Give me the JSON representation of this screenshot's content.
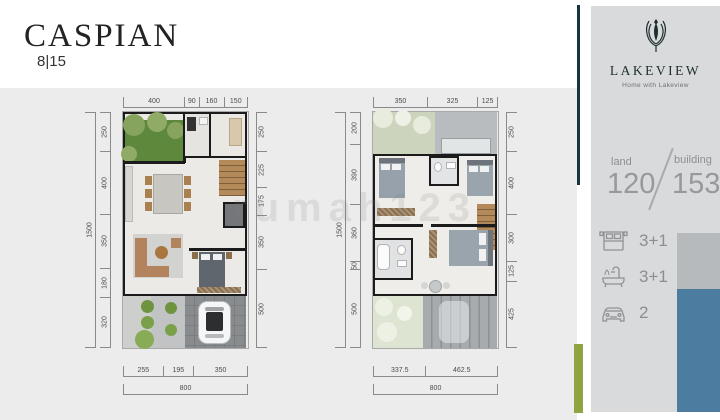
{
  "title": {
    "name": "CASPIAN",
    "lot": "8|15"
  },
  "watermark": "rumah123",
  "sidebar": {
    "brand": "LAKEVIEW",
    "tagline": "Home with Lakeview",
    "land_label": "land",
    "land_value": "120",
    "building_label": "building",
    "building_value": "153",
    "specs": [
      {
        "icon": "bed-icon",
        "value": "3+1"
      },
      {
        "icon": "bathtub-icon",
        "value": "3+1"
      },
      {
        "icon": "car-icon",
        "value": "2"
      }
    ],
    "colors": {
      "accent_teal": "#17353c",
      "accent_green": "#8ea43e",
      "panel_gray": "#d8dadb",
      "block_gray": "#b6babd",
      "block_blue": "#4d7ca1"
    }
  },
  "ground_floor": {
    "dims_top": [
      "400",
      "90",
      "160",
      "150"
    ],
    "dims_left": [
      "250",
      "400",
      "350",
      "180",
      "320"
    ],
    "dims_right": [
      "250",
      "225",
      "175",
      "350",
      "500"
    ],
    "dims_bottom": [
      "255",
      "195",
      "350"
    ],
    "total_left": [
      "1500"
    ],
    "total_bottom": [
      "800"
    ]
  },
  "upper_floor": {
    "dims_top": [
      "350",
      "325",
      "125"
    ],
    "dims_left": [
      "200",
      "390",
      "360",
      "50",
      "500"
    ],
    "dims_right": [
      "250",
      "400",
      "300",
      "125",
      "425"
    ],
    "dims_bottom": [
      "337.5",
      "462.5"
    ],
    "total_left": [
      "1500"
    ],
    "total_bottom": [
      "800"
    ]
  }
}
